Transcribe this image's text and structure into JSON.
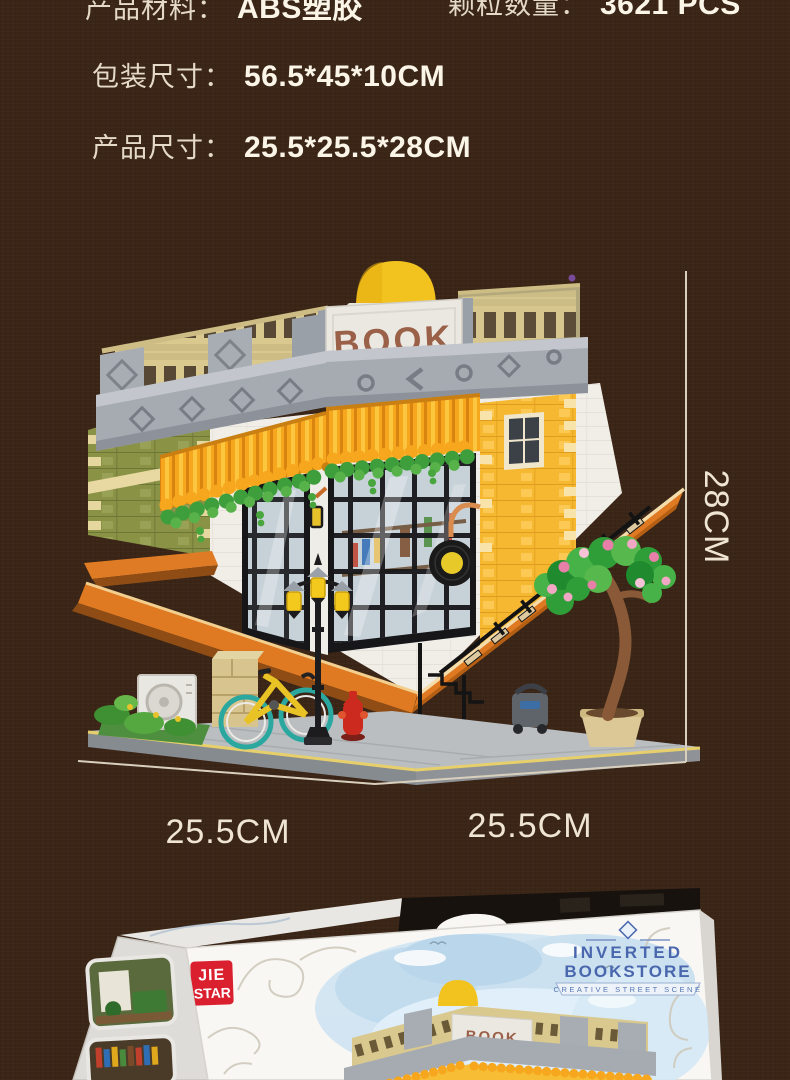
{
  "specs": {
    "material_label": "产品材料：",
    "material_value": "ABS塑胶",
    "pieces_label": "颗粒数量：",
    "pieces_value": "3621 PCS",
    "package_label": "包装尺寸：",
    "package_value": "56.5*45*10CM",
    "product_label": "产品尺寸：",
    "product_value": "25.5*25.5*28CM"
  },
  "photo": {
    "building_sign": "BOOK",
    "dim_height": "28CM",
    "dim_width_left": "25.5CM",
    "dim_width_right": "25.5CM"
  },
  "box": {
    "brand_top": "JIE",
    "brand_bottom": "STAR",
    "title_line1": "INVERTED",
    "title_line2": "BOOKSTORE",
    "tagline": "CREATIVE STREET SCENE",
    "building_sign": "BOOK"
  },
  "colors": {
    "background": "#3A2516",
    "text_cream": "#F0E6D2",
    "wall_yellow": "#F6B831",
    "wall_olive": "#8A9246",
    "awning_orange": "#F6A71E",
    "fascia_orange": "#E07A22",
    "brand_red": "#DA1F2E",
    "badge_blue": "#4A67AE"
  }
}
